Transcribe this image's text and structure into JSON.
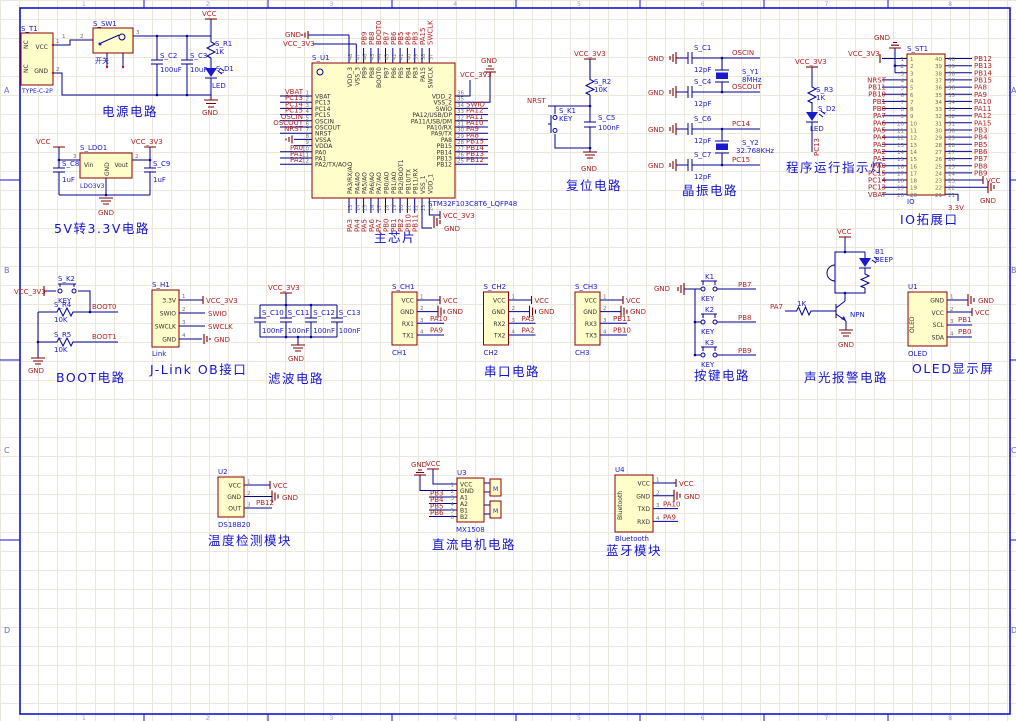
{
  "sheet": {
    "row_markers": [
      "A",
      "B",
      "C",
      "D"
    ],
    "col_markers": [
      "1",
      "2",
      "3",
      "4",
      "5",
      "6",
      "7",
      "8"
    ]
  },
  "power": {
    "title": "电源电路",
    "t1": {
      "ref": "S_T1",
      "part": "TYPE-C-2P",
      "pin_vcc": "VCC",
      "pin_gnd": "GND",
      "nc": [
        "NC",
        "NC"
      ],
      "nums": [
        "1",
        "2"
      ]
    },
    "sw": {
      "ref": "S_SW1",
      "label": "开关",
      "nums": [
        "1",
        "2",
        "3"
      ]
    },
    "c2_ref": "S_C2",
    "c2_val": "100uF",
    "c3_ref": "S_C3",
    "c3_val": "10uF",
    "r1_ref": "S_R1",
    "r1_val": "1K",
    "d1_ref": "S_D1",
    "d1_val": "LED",
    "vcc": "VCC",
    "gnd": "GND"
  },
  "ldo": {
    "title": "5V转3.3V电路",
    "ref": "S_LDO1",
    "part": "LDO3V3",
    "pin_vin": "Vin",
    "pin_vout": "Vout",
    "pin_gnd": "GND",
    "num_in": "3",
    "num_out": "2",
    "c8_ref": "S_C8",
    "c8_val": "1uF",
    "c9_ref": "S_C9",
    "c9_val": "1uF",
    "vcc": "VCC",
    "v33": "VCC_3V3",
    "gnd": "GND"
  },
  "mcu": {
    "title": "主芯片",
    "ref": "S_U1",
    "part": "STM32F103C8T6_LQFP48",
    "left_nums": [
      "1",
      "2",
      "3",
      "4",
      "5",
      "6",
      "7",
      "8",
      "9",
      "10",
      "11",
      "12"
    ],
    "left_names": [
      "VBAT",
      "PC13",
      "PC14",
      "PC15",
      "OSCIN",
      "OSCOUT",
      "NRST",
      "VSSA",
      "VDDA",
      "PA0",
      "PA1",
      "PA2/TX/AO"
    ],
    "left_nets": [
      "VBAT",
      "PC13",
      "PC14",
      "PC15",
      "OSCIN",
      "OSCOUT",
      "NRST",
      "",
      "",
      "PA0",
      "PA1",
      "PA2"
    ],
    "right_nums": [
      "36",
      "35",
      "34",
      "33",
      "32",
      "31",
      "30",
      "29",
      "28",
      "27",
      "26",
      "25"
    ],
    "right_names": [
      "VDD_2",
      "VSS_2",
      "SWIO",
      "PA12/USB/DP",
      "PA11/USB/DM",
      "PA10/RX",
      "PA9/TX",
      "PA8",
      "PB15",
      "PB14",
      "PB13",
      "PB12"
    ],
    "right_nets": [
      "",
      "",
      "SWIO",
      "PA12",
      "PA11",
      "PA10",
      "PA9",
      "PA8",
      "PB15",
      "PB14",
      "PB13",
      "PB12"
    ],
    "top_nums": [
      "48",
      "47",
      "46",
      "45",
      "44",
      "43",
      "42",
      "41",
      "40",
      "39",
      "38",
      "37"
    ],
    "top_names": [
      "VDD_3",
      "VSS_3",
      "PB9",
      "PB8",
      "BOOT0",
      "PB7",
      "PB6",
      "PB5",
      "PB4",
      "PB3",
      "PA15",
      "SWCLK"
    ],
    "top_nets": [
      "",
      "",
      "PB9",
      "PB8",
      "BOOT0",
      "PB7",
      "PB6",
      "PB5",
      "PB4",
      "PB3",
      "PA15",
      "SWCLK"
    ],
    "bottom_nums": [
      "13",
      "14",
      "15",
      "16",
      "17",
      "18",
      "19",
      "20",
      "21",
      "22",
      "23",
      "24"
    ],
    "bottom_names": [
      "PA3/RX/AO",
      "PA4/AO",
      "PA5/AO",
      "PA6/AO",
      "PA7/AO",
      "PB0/AO",
      "PB1/AO",
      "PB2/BOOT1",
      "PB10/TX",
      "PB11/RX",
      "VSS_1",
      "VDD_1"
    ],
    "bottom_nets": [
      "PA3",
      "PA4",
      "PA5",
      "PA6",
      "PA7",
      "PB0",
      "PB1",
      "PB2",
      "PB10",
      "PB11"
    ],
    "v33": "VCC_3V3",
    "gnd": "GND"
  },
  "reset": {
    "title": "复位电路",
    "r2_ref": "S_R2",
    "r2_val": "10K",
    "k1_ref": "S_K1",
    "k1_val": "KEY",
    "c5_ref": "S_C5",
    "c5_val": "100nF",
    "v33": "VCC_3V3",
    "nrst": "NRST",
    "gnd": "GND"
  },
  "crystal": {
    "title": "晶振电路",
    "gnd": "GND",
    "c1_ref": "S_C1",
    "c1_val": "12pF",
    "c4_ref": "S_C4",
    "c4_val": "12pF",
    "c6_ref": "S_C6",
    "c6_val": "12pF",
    "c7_ref": "S_C7",
    "c7_val": "12pF",
    "y1_ref": "S_Y1",
    "y1_val": "8MHz",
    "y2_ref": "S_Y2",
    "y2_val": "32.768KHz",
    "oscin": "OSCIN",
    "oscout": "OSCOUT",
    "pc14": "PC14",
    "pc15": "PC15"
  },
  "runled": {
    "title": "程序运行指示灯",
    "r3_ref": "S_R3",
    "r3_val": "1K",
    "d2_ref": "S_D2",
    "d2_val": "LED",
    "v33": "VCC_3V3",
    "net": "PC13"
  },
  "io": {
    "title": "IO拓展口",
    "ref": "S_ST1",
    "part": "IO",
    "left_nums": [
      "1",
      "2",
      "3",
      "4",
      "5",
      "6",
      "7",
      "8",
      "9",
      "10",
      "11",
      "12",
      "13",
      "14",
      "15",
      "16",
      "17",
      "18",
      "19",
      "20"
    ],
    "right_nums": [
      "40",
      "39",
      "38",
      "37",
      "36",
      "35",
      "34",
      "33",
      "32",
      "31",
      "30",
      "29",
      "28",
      "27",
      "26",
      "25",
      "24",
      "23",
      "22",
      "21"
    ],
    "left_nets": [
      "NRST",
      "PB11",
      "PB10",
      "PB1",
      "PB0",
      "PA7",
      "PA6",
      "PA5",
      "PA4",
      "PA3",
      "PA2",
      "PA1",
      "PA0",
      "PC15",
      "PC14",
      "PC13",
      "VBAT"
    ],
    "right_nets": [
      "PB12",
      "PB13",
      "PB14",
      "PB15",
      "PA8",
      "PA9",
      "PA10",
      "PA11",
      "PA12",
      "PA15",
      "PB3",
      "PB4",
      "PB5",
      "PB6",
      "PB7",
      "PB8",
      "PB9"
    ],
    "v33": "VCC_3V3",
    "gnd_top": "GND",
    "vcc": "VCC",
    "gnd_bot": "GND",
    "v33_bot": "3.3V"
  },
  "boot": {
    "title": "BOOT电路",
    "k2_ref": "S_K2",
    "k2_val": "KEY",
    "r4_ref": "S_R4",
    "r4_val": "10K",
    "r5_ref": "S_R5",
    "r5_val": "10K",
    "v33": "VCC_3V3",
    "boot0": "BOOT0",
    "boot1": "BOOT1",
    "gnd": "GND"
  },
  "jlink": {
    "title": "J-Link OB接口",
    "ref": "S_H1",
    "part": "Link",
    "pins": [
      "3.3V",
      "SWIO",
      "SWCLK",
      "GND"
    ],
    "nums": [
      "1",
      "2",
      "3",
      "4"
    ],
    "net_v33": "VCC_3V3",
    "net_swio": "SWIO",
    "net_swclk": "SWCLK",
    "net_gnd": "GND"
  },
  "filter": {
    "title": "滤波电路",
    "refs": [
      "S_C10",
      "S_C11",
      "S_C12",
      "S_C13"
    ],
    "vals": [
      "100nF",
      "100nF",
      "100nF",
      "100nF"
    ],
    "v33": "VCC_3V3",
    "gnd": "GND"
  },
  "uart": {
    "title": "串口电路",
    "ch1": {
      "ref": "S_CH1",
      "part": "CH1",
      "pins": [
        "VCC",
        "GND",
        "RX1",
        "TX1"
      ],
      "nums": [
        "1",
        "2",
        "3",
        "4"
      ],
      "nets": [
        "VCC",
        "GND",
        "PA10",
        "PA9"
      ]
    },
    "ch2": {
      "ref": "S_CH2",
      "part": "CH2",
      "pins": [
        "VCC",
        "GND",
        "RX2",
        "TX2"
      ],
      "nums": [
        "1",
        "2",
        "3",
        "4"
      ],
      "nets": [
        "VCC",
        "GND",
        "PA3",
        "PA2"
      ]
    },
    "ch3": {
      "ref": "S_CH3",
      "part": "CH3",
      "pins": [
        "VCC",
        "GND",
        "RX3",
        "TX3"
      ],
      "nums": [
        "1",
        "2",
        "3",
        "4"
      ],
      "nets": [
        "VCC",
        "GND",
        "PB11",
        "PB10"
      ]
    }
  },
  "keys": {
    "title": "按键电路",
    "gnd": "GND",
    "refs": [
      "K1",
      "K2",
      "K3"
    ],
    "labels": [
      "KEY",
      "KEY",
      "KEY"
    ],
    "nets": [
      "PB7",
      "PB8",
      "PB9"
    ]
  },
  "alarm": {
    "title": "声光报警电路",
    "vcc": "VCC",
    "b1_ref": "B1",
    "b1_val": "BEEP",
    "r_val": "1K",
    "q": "NPN",
    "net_in": "PA7",
    "gnd": "GND"
  },
  "oled": {
    "title": "OLED显示屏",
    "ref": "U1",
    "part": "OLED",
    "side": "OLED",
    "pins": [
      "GND",
      "VCC",
      "SCL",
      "SDA"
    ],
    "nums": [
      "1",
      "2",
      "3",
      "4"
    ],
    "net_gnd": "GND",
    "net_vcc": "VCC",
    "net_scl": "PB1",
    "net_sda": "PB0"
  },
  "temp": {
    "title": "温度检测模块",
    "ref": "U2",
    "part": "DS18B20",
    "pins": [
      "VCC",
      "GND",
      "OUT"
    ],
    "nums": [
      "1",
      "2",
      "3"
    ],
    "net_vcc": "VCC",
    "net_gnd": "GND",
    "net_out": "PB12"
  },
  "motor": {
    "title": "直流电机电路",
    "ref": "U3",
    "part": "MX1508",
    "pins": [
      "VCC",
      "GND",
      "A1",
      "A2",
      "B1",
      "B2"
    ],
    "nums": [
      "1",
      "2",
      "3",
      "4",
      "5",
      "6"
    ],
    "nets": [
      "PB3",
      "PB4",
      "PB5",
      "PB6"
    ],
    "gnd": "GND",
    "vcc": "VCC",
    "m": "M"
  },
  "bt": {
    "title": "蓝牙模块",
    "ref": "U4",
    "part": "Bluetooth",
    "side": "Bluetooth",
    "pins": [
      "VCC",
      "GND",
      "TXD",
      "RXD"
    ],
    "nums": [
      "1",
      "2",
      "3",
      "4"
    ],
    "net_vcc": "VCC",
    "net_gnd": "GND",
    "net_txd": "PA10",
    "net_rxd": "PA9"
  }
}
